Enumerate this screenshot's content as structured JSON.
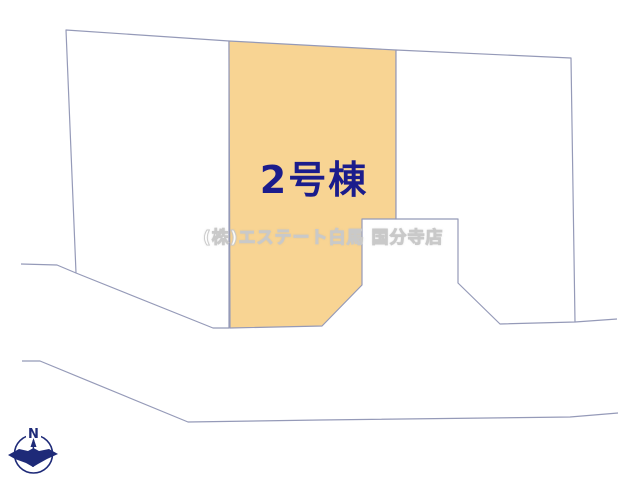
{
  "page": {
    "lot_label": "2号棟",
    "watermark": "(株)エステート白馬 国分寺店",
    "compass": {
      "north_label": "N"
    },
    "colors": {
      "lot_highlight_fill": "#F8D493",
      "boundary_line": "#959AB8",
      "lot_label_text": "#1B1C8C",
      "compass_navy": "#1E2A78",
      "watermark_text": "#FFFFFF"
    }
  }
}
